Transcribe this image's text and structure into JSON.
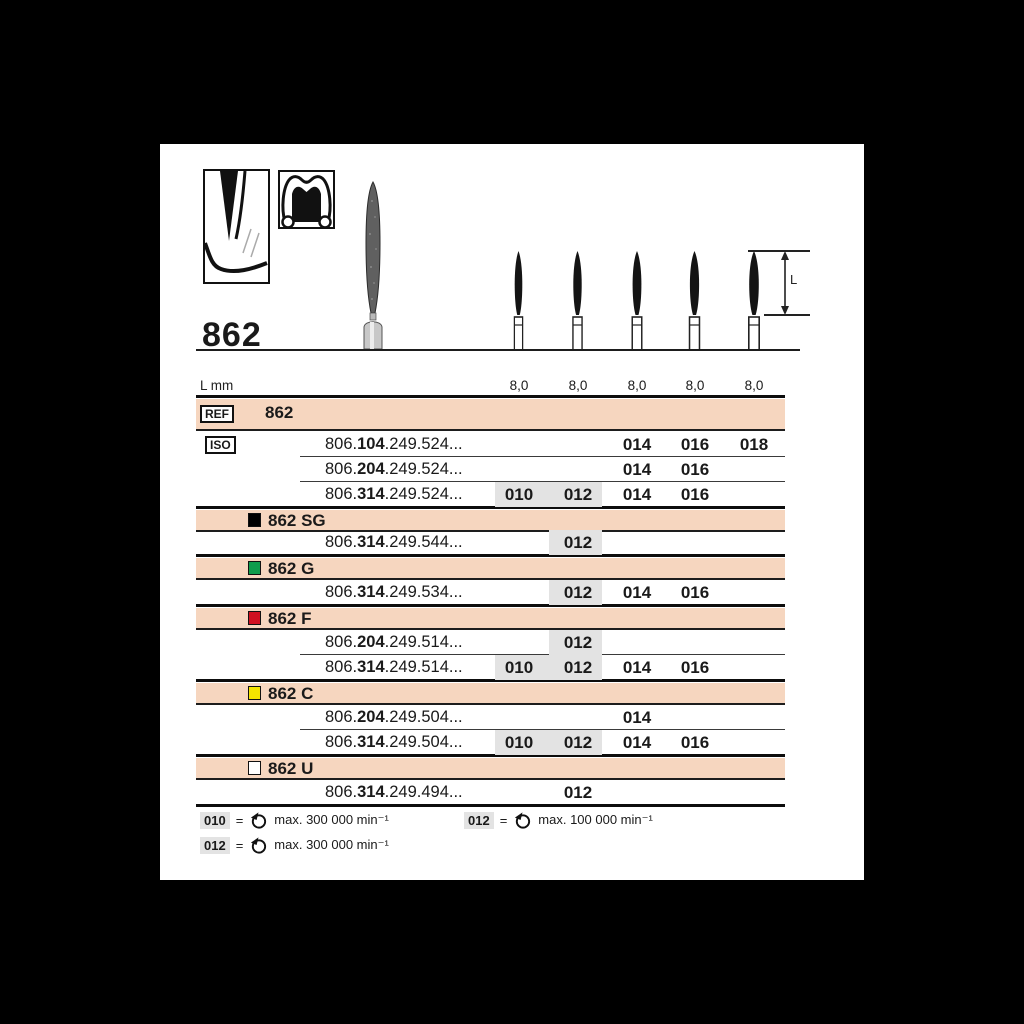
{
  "header": {
    "product_number": "862",
    "length_row_label": "L mm",
    "dimension_label": "L",
    "lengths": [
      "8,0",
      "8,0",
      "8,0",
      "8,0",
      "8,0"
    ]
  },
  "table": {
    "ref_box_label": "REF",
    "ref_value": "862",
    "iso_box_label": "ISO",
    "bands": [
      {
        "label": "862 SG"
      },
      {
        "label": "862 G"
      },
      {
        "label": "862 F"
      },
      {
        "label": "862 C"
      },
      {
        "label": "862 U"
      }
    ],
    "rows": [
      {
        "prefix": "806.",
        "bold": "104",
        "suffix": ".249.524...",
        "sizes": {
          "s014": "014",
          "s016": "016",
          "s018": "018"
        }
      },
      {
        "prefix": "806.",
        "bold": "204",
        "suffix": ".249.524...",
        "sizes": {
          "s014": "014",
          "s016": "016"
        }
      },
      {
        "prefix": "806.",
        "bold": "314",
        "suffix": ".249.524...",
        "sizes": {
          "s010": "010",
          "s012": "012",
          "s014": "014",
          "s016": "016"
        }
      },
      {
        "prefix": "806.",
        "bold": "314",
        "suffix": ".249.544...",
        "sizes": {
          "s012": "012"
        }
      },
      {
        "prefix": "806.",
        "bold": "314",
        "suffix": ".249.534...",
        "sizes": {
          "s012": "012",
          "s014": "014",
          "s016": "016"
        }
      },
      {
        "prefix": "806.",
        "bold": "204",
        "suffix": ".249.514...",
        "sizes": {
          "s012": "012"
        }
      },
      {
        "prefix": "806.",
        "bold": "314",
        "suffix": ".249.514...",
        "sizes": {
          "s010": "010",
          "s012": "012",
          "s014": "014",
          "s016": "016"
        }
      },
      {
        "prefix": "806.",
        "bold": "204",
        "suffix": ".249.504...",
        "sizes": {
          "s014": "014"
        }
      },
      {
        "prefix": "806.",
        "bold": "314",
        "suffix": ".249.504...",
        "sizes": {
          "s010": "010",
          "s012": "012",
          "s014": "014",
          "s016": "016"
        }
      },
      {
        "prefix": "806.",
        "bold": "314",
        "suffix": ".249.494...",
        "sizes": {
          "s012": "012"
        }
      }
    ]
  },
  "legend": {
    "items": [
      {
        "size": "010",
        "equals": "=",
        "text": "max. 300 000 min⁻¹"
      },
      {
        "size": "012",
        "equals": "=",
        "text": "max. 100 000 min⁻¹"
      },
      {
        "size": "012",
        "equals": "=",
        "text": "max. 300 000 min⁻¹"
      }
    ]
  },
  "colors": {
    "band_bg": "#f6d6bf",
    "highlight": "#e3e3e3",
    "grade_sg": "#000000",
    "grade_g": "#0e9c4c",
    "grade_f": "#d01020",
    "grade_c": "#f4e400",
    "grade_u": "#ffffff"
  }
}
